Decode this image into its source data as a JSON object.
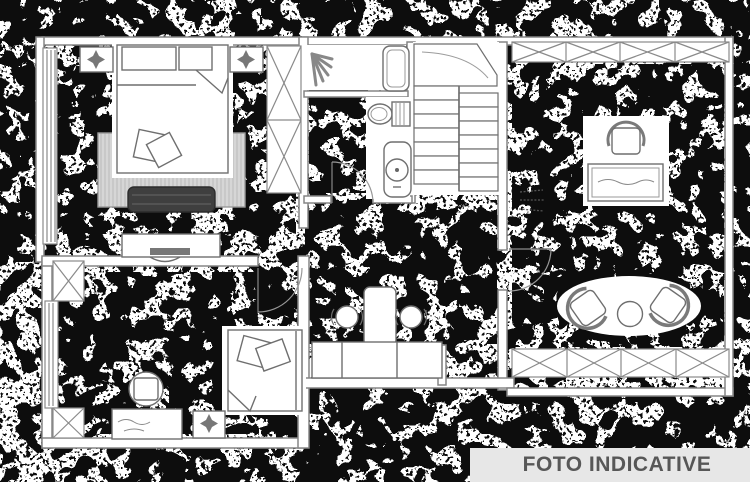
{
  "banner": {
    "label": "FOTO INDICATIVE",
    "background": "#e7e7e7",
    "text_color": "#575757"
  },
  "plan": {
    "background": "#ffffff",
    "wall_color": "#858585",
    "furniture_color": "#6f6f6f",
    "noise_color": "#0a0a0a",
    "rug_color": "#d6d6d6",
    "bench_color": "#3f3f3f",
    "rooms": [
      "master-bedroom",
      "second-bedroom",
      "bathroom",
      "staircase",
      "hallway-vanity",
      "living-room"
    ]
  }
}
